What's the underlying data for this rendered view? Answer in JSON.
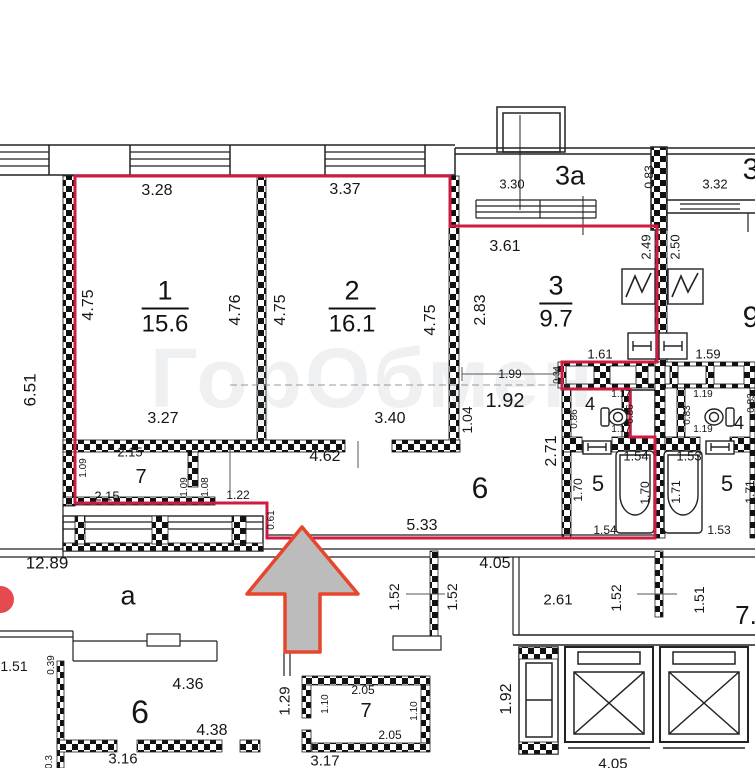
{
  "plan": {
    "watermark": {
      "text": "ГорОбмен"
    },
    "colors": {
      "boundary": "#cf1b42",
      "arrow_fill": "#bcbcbc",
      "arrow_stroke": "#e8462c",
      "wall": "#111111",
      "watermark_accent": "#e23b3f"
    },
    "rooms": [
      {
        "number": "1",
        "area": "15.6",
        "x": 165,
        "y": 307
      },
      {
        "number": "2",
        "area": "16.1",
        "x": 352,
        "y": 307
      },
      {
        "number": "3",
        "area": "9.7",
        "x": 556,
        "y": 302
      }
    ],
    "labels": [
      {
        "t": "3.28",
        "x": 157,
        "y": 191,
        "s": 16
      },
      {
        "t": "3.37",
        "x": 345,
        "y": 190,
        "s": 16
      },
      {
        "t": "3.30",
        "x": 512,
        "y": 184,
        "s": 13
      },
      {
        "t": "3a",
        "x": 570,
        "y": 176,
        "s": 27
      },
      {
        "t": "0.83",
        "x": 649,
        "y": 177,
        "r": 1,
        "s": 12
      },
      {
        "t": "3.32",
        "x": 715,
        "y": 184,
        "s": 13
      },
      {
        "t": "3",
        "x": 751,
        "y": 170,
        "s": 30
      },
      {
        "t": "3.61",
        "x": 505,
        "y": 247,
        "s": 16
      },
      {
        "t": "2.49",
        "x": 646,
        "y": 247,
        "r": 1,
        "s": 13
      },
      {
        "t": "2.50",
        "x": 675,
        "y": 247,
        "r": 1,
        "s": 13
      },
      {
        "t": "6.51",
        "x": 30,
        "y": 390,
        "r": 1,
        "s": 17
      },
      {
        "t": "4.75",
        "x": 89,
        "y": 305,
        "r": 1,
        "s": 16
      },
      {
        "t": "4.76",
        "x": 236,
        "y": 310,
        "r": 1,
        "s": 16
      },
      {
        "t": "4.75",
        "x": 281,
        "y": 310,
        "r": 1,
        "s": 16
      },
      {
        "t": "4.75",
        "x": 431,
        "y": 320,
        "r": 1,
        "s": 16
      },
      {
        "t": "2.83",
        "x": 481,
        "y": 310,
        "r": 1,
        "s": 16
      },
      {
        "t": "9",
        "x": 751,
        "y": 318,
        "s": 30
      },
      {
        "t": "1.99",
        "x": 510,
        "y": 374,
        "s": 12
      },
      {
        "t": "0.34",
        "x": 557,
        "y": 375,
        "r": 1,
        "s": 9
      },
      {
        "t": "1.61",
        "x": 600,
        "y": 354,
        "s": 13
      },
      {
        "t": "1.59",
        "x": 708,
        "y": 354,
        "s": 13
      },
      {
        "t": "1.92",
        "x": 505,
        "y": 401,
        "s": 20
      },
      {
        "t": "1.04",
        "x": 467,
        "y": 420,
        "r": 1,
        "s": 14
      },
      {
        "t": "4",
        "x": 590,
        "y": 404,
        "s": 18
      },
      {
        "t": "0.86",
        "x": 575,
        "y": 419,
        "r": 1,
        "s": 10
      },
      {
        "t": "1.17",
        "x": 621,
        "y": 395,
        "s": 10
      },
      {
        "t": "0.86",
        "x": 631,
        "y": 414,
        "r": 1,
        "s": 10
      },
      {
        "t": "1.17",
        "x": 621,
        "y": 430,
        "s": 10
      },
      {
        "t": "1.19",
        "x": 703,
        "y": 395,
        "s": 10
      },
      {
        "t": "0.83",
        "x": 688,
        "y": 415,
        "r": 1,
        "s": 10
      },
      {
        "t": "4",
        "x": 739,
        "y": 423,
        "s": 18
      },
      {
        "t": "1.19",
        "x": 703,
        "y": 430,
        "s": 10
      },
      {
        "t": "0.83",
        "x": 752,
        "y": 403,
        "r": 1,
        "s": 10
      },
      {
        "t": "2.71",
        "x": 552,
        "y": 451,
        "r": 1,
        "s": 16
      },
      {
        "t": "3.27",
        "x": 163,
        "y": 419,
        "s": 16
      },
      {
        "t": "3.40",
        "x": 390,
        "y": 419,
        "s": 16
      },
      {
        "t": "4.62",
        "x": 325,
        "y": 457,
        "s": 16
      },
      {
        "t": "2.15",
        "x": 130,
        "y": 452,
        "s": 13
      },
      {
        "t": "7",
        "x": 141,
        "y": 477,
        "s": 20
      },
      {
        "t": "1.09",
        "x": 84,
        "y": 468,
        "r": 1,
        "s": 10
      },
      {
        "t": "2.15",
        "x": 107,
        "y": 496,
        "s": 13
      },
      {
        "t": "1.09",
        "x": 185,
        "y": 487,
        "r": 1,
        "s": 10
      },
      {
        "t": "1.08",
        "x": 206,
        "y": 487,
        "r": 1,
        "s": 10
      },
      {
        "t": "1.22",
        "x": 238,
        "y": 495,
        "s": 12
      },
      {
        "t": "0.61",
        "x": 272,
        "y": 520,
        "r": 1,
        "s": 10
      },
      {
        "t": "6",
        "x": 480,
        "y": 489,
        "s": 30
      },
      {
        "t": "5.33",
        "x": 422,
        "y": 526,
        "s": 16
      },
      {
        "t": "1.54",
        "x": 636,
        "y": 456,
        "s": 13
      },
      {
        "t": "1.53",
        "x": 689,
        "y": 456,
        "s": 13
      },
      {
        "t": "5",
        "x": 598,
        "y": 484,
        "s": 22
      },
      {
        "t": "1.70",
        "x": 578,
        "y": 490,
        "r": 1,
        "s": 12
      },
      {
        "t": "1.70",
        "x": 645,
        "y": 493,
        "r": 1,
        "s": 12
      },
      {
        "t": "1.71",
        "x": 676,
        "y": 492,
        "r": 1,
        "s": 12
      },
      {
        "t": "5",
        "x": 727,
        "y": 484,
        "s": 22
      },
      {
        "t": "1.71",
        "x": 750,
        "y": 492,
        "r": 1,
        "s": 12
      },
      {
        "t": "1.54",
        "x": 605,
        "y": 530,
        "s": 12
      },
      {
        "t": "1.53",
        "x": 719,
        "y": 530,
        "s": 12
      },
      {
        "t": "12.89",
        "x": 47,
        "y": 563,
        "s": 17
      },
      {
        "t": "а",
        "x": 128,
        "y": 596,
        "s": 27
      },
      {
        "t": "4.05",
        "x": 495,
        "y": 564,
        "s": 16
      },
      {
        "t": "1.52",
        "x": 394,
        "y": 597,
        "r": 1,
        "s": 14
      },
      {
        "t": "1.52",
        "x": 452,
        "y": 597,
        "r": 1,
        "s": 14
      },
      {
        "t": "1.52",
        "x": 616,
        "y": 598,
        "r": 1,
        "s": 14
      },
      {
        "t": "1.51",
        "x": 699,
        "y": 600,
        "r": 1,
        "s": 14
      },
      {
        "t": "2.61",
        "x": 558,
        "y": 600,
        "s": 15
      },
      {
        "t": "7.",
        "x": 746,
        "y": 615,
        "s": 26
      },
      {
        "t": "1.51",
        "x": 14,
        "y": 666,
        "s": 14
      },
      {
        "t": "0.39",
        "x": 52,
        "y": 665,
        "r": 1,
        "s": 10
      },
      {
        "t": "4.36",
        "x": 188,
        "y": 685,
        "s": 16
      },
      {
        "t": "6",
        "x": 140,
        "y": 712,
        "s": 32
      },
      {
        "t": "4.38",
        "x": 212,
        "y": 731,
        "s": 16
      },
      {
        "t": "1.29",
        "x": 285,
        "y": 701,
        "r": 1,
        "s": 15
      },
      {
        "t": "1.10",
        "x": 326,
        "y": 704,
        "r": 1,
        "s": 10
      },
      {
        "t": "2.05",
        "x": 363,
        "y": 690,
        "s": 12
      },
      {
        "t": "7",
        "x": 366,
        "y": 711,
        "s": 20
      },
      {
        "t": "2.05",
        "x": 390,
        "y": 735,
        "s": 12
      },
      {
        "t": "1.10",
        "x": 415,
        "y": 711,
        "r": 1,
        "s": 10
      },
      {
        "t": "1.92",
        "x": 507,
        "y": 699,
        "r": 1,
        "s": 16
      },
      {
        "t": "3.16",
        "x": 123,
        "y": 759,
        "s": 15
      },
      {
        "t": "3.17",
        "x": 325,
        "y": 761,
        "s": 15
      },
      {
        "t": "4.05",
        "x": 613,
        "y": 764,
        "s": 15
      },
      {
        "t": "0.3",
        "x": 50,
        "y": 762,
        "r": 1,
        "s": 10
      }
    ]
  }
}
